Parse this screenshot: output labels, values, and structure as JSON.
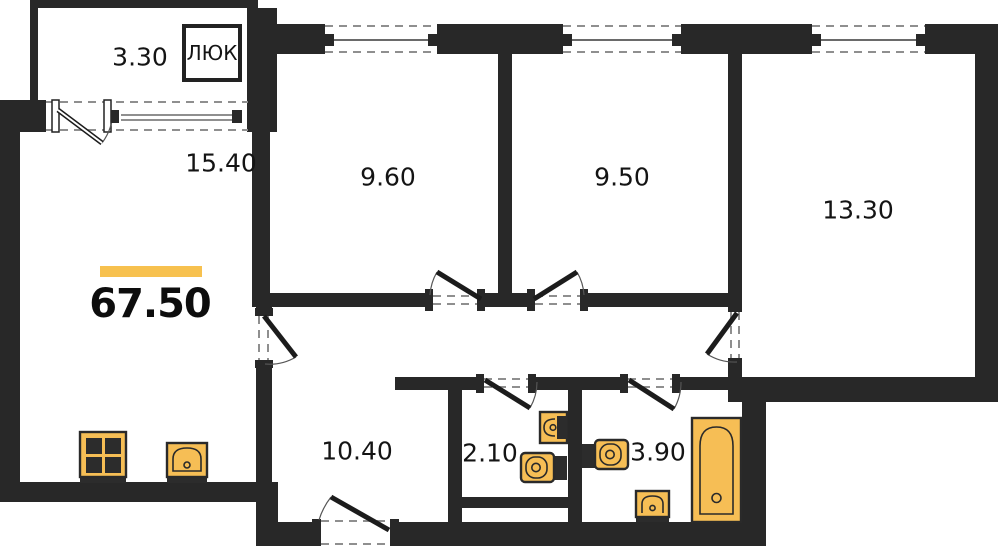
{
  "plan": {
    "total_area": "67.50",
    "hatch_label": "ЛЮК",
    "rooms": {
      "balcony": "3.30",
      "living_kitchen": "15.40",
      "bedroom1": "9.60",
      "bedroom2": "9.50",
      "bedroom3": "13.30",
      "hallway": "10.40",
      "wc": "2.10",
      "bathroom": "3.90"
    },
    "colors": {
      "wall": "#282828",
      "fixture": "#F6BE55",
      "accent_bar": "#F7C14F",
      "background": "#FFFFFF"
    }
  }
}
